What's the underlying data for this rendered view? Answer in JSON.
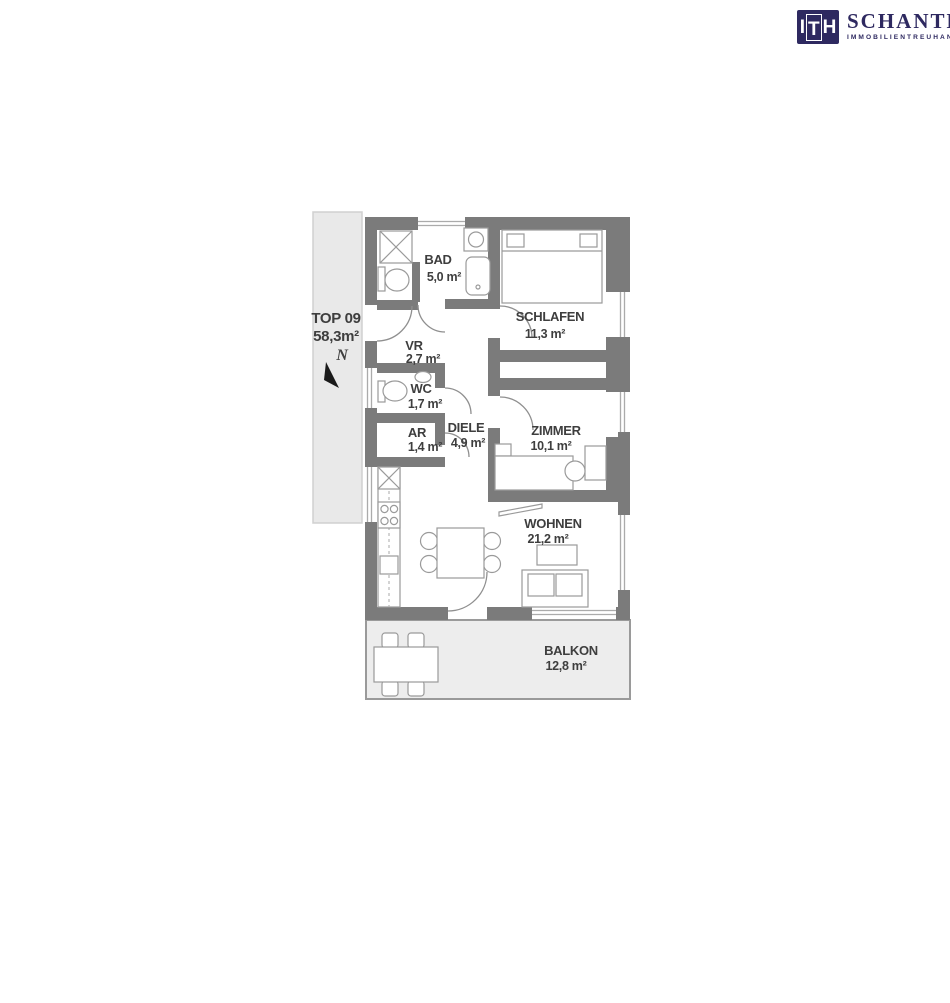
{
  "logo": {
    "mark_letters": [
      "I",
      "T",
      "H"
    ],
    "name": "SCHANTL",
    "tagline": "IMMOBILIENTREUHAND",
    "brand_color": "#2e2960"
  },
  "unit": {
    "id": "TOP 09",
    "total_area": "58,3m²"
  },
  "compass": {
    "label": "N"
  },
  "rooms": {
    "bad": {
      "name": "BAD",
      "area": "5,0 m²"
    },
    "schlafen": {
      "name": "SCHLAFEN",
      "area": "11,3 m²"
    },
    "vr": {
      "name": "VR",
      "area": "2,7 m²"
    },
    "wc": {
      "name": "WC",
      "area": "1,7 m²"
    },
    "ar": {
      "name": "AR",
      "area": "1,4 m²"
    },
    "diele": {
      "name": "DIELE",
      "area": "4,9 m²"
    },
    "zimmer": {
      "name": "ZIMMER",
      "area": "10,1 m²"
    },
    "wohnen": {
      "name": "WOHNEN",
      "area": "21,2 m²"
    },
    "balkon": {
      "name": "BALKON",
      "area": "12,8 m²"
    }
  },
  "colors": {
    "wall": "#7b7b7b",
    "shaded_area": "#e9e9e9",
    "outline": "#9a9a9a",
    "text": "#3e3e3e"
  }
}
